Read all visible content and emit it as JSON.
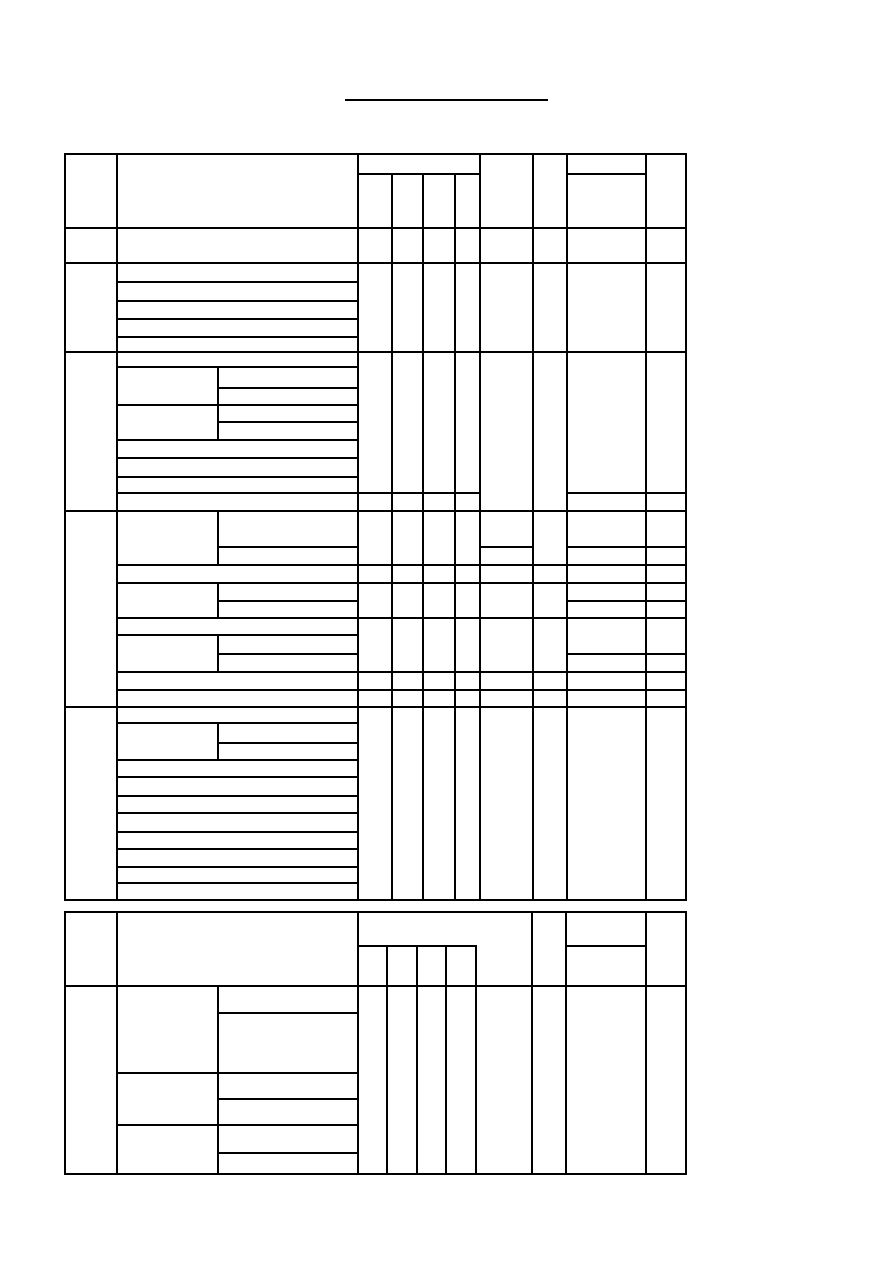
{
  "page": {
    "width": 893,
    "height": 1262,
    "background_color": "#ffffff",
    "line_color": "#000000",
    "line_thickness": 1.5
  },
  "title": {
    "text": "",
    "underline": {
      "x": 345,
      "y": 99,
      "width": 203,
      "thickness": 2
    }
  },
  "tables": [
    {
      "name": "upper-table",
      "vertical_lines": [
        [
          65,
          154,
          900
        ],
        [
          117,
          154,
          900
        ],
        [
          358,
          154,
          900
        ],
        [
          392,
          174,
          900
        ],
        [
          423,
          174,
          900
        ],
        [
          455,
          174,
          900
        ],
        [
          480,
          154,
          900
        ],
        [
          533,
          154,
          900
        ],
        [
          567,
          154,
          900
        ],
        [
          646,
          154,
          900
        ],
        [
          686,
          154,
          900
        ],
        [
          218,
          367,
          440
        ],
        [
          218,
          511,
          565
        ],
        [
          218,
          583,
          618
        ],
        [
          218,
          635,
          670
        ],
        [
          218,
          723,
          760
        ]
      ],
      "horizontal_lines": [
        [
          154,
          65,
          686
        ],
        [
          174,
          358,
          480
        ],
        [
          174,
          567,
          646
        ],
        [
          228,
          65,
          686
        ],
        [
          263,
          65,
          686
        ],
        [
          282,
          117,
          358
        ],
        [
          301,
          117,
          358
        ],
        [
          319,
          117,
          358
        ],
        [
          337,
          117,
          358
        ],
        [
          352,
          65,
          686
        ],
        [
          367,
          117,
          358
        ],
        [
          388,
          218,
          358
        ],
        [
          405,
          117,
          358
        ],
        [
          422,
          218,
          358
        ],
        [
          440,
          117,
          358
        ],
        [
          458,
          117,
          358
        ],
        [
          477,
          117,
          358
        ],
        [
          493,
          117,
          480
        ],
        [
          493,
          567,
          686
        ],
        [
          511,
          65,
          686
        ],
        [
          547,
          218,
          358
        ],
        [
          547,
          480,
          533
        ],
        [
          547,
          567,
          686
        ],
        [
          565,
          117,
          686
        ],
        [
          583,
          117,
          686
        ],
        [
          601,
          218,
          358
        ],
        [
          601,
          567,
          686
        ],
        [
          618,
          117,
          686
        ],
        [
          635,
          117,
          358
        ],
        [
          654,
          218,
          358
        ],
        [
          654,
          567,
          686
        ],
        [
          672,
          117,
          686
        ],
        [
          690,
          117,
          686
        ],
        [
          707,
          65,
          686
        ],
        [
          723,
          117,
          358
        ],
        [
          743,
          218,
          358
        ],
        [
          760,
          117,
          358
        ],
        [
          777,
          117,
          358
        ],
        [
          796,
          117,
          358
        ],
        [
          813,
          117,
          358
        ],
        [
          832,
          117,
          358
        ],
        [
          849,
          117,
          358
        ],
        [
          867,
          117,
          358
        ],
        [
          883,
          117,
          358
        ],
        [
          900,
          65,
          686
        ]
      ]
    },
    {
      "name": "lower-table",
      "vertical_lines": [
        [
          65,
          912,
          1174
        ],
        [
          117,
          912,
          1174
        ],
        [
          218,
          986,
          1174
        ],
        [
          358,
          912,
          1174
        ],
        [
          387,
          946,
          1174
        ],
        [
          417,
          946,
          1174
        ],
        [
          446,
          946,
          1174
        ],
        [
          476,
          946,
          1174
        ],
        [
          532,
          912,
          1174
        ],
        [
          566,
          912,
          1174
        ],
        [
          646,
          912,
          1174
        ],
        [
          686,
          912,
          1174
        ]
      ],
      "horizontal_lines": [
        [
          912,
          65,
          686
        ],
        [
          946,
          358,
          476
        ],
        [
          946,
          566,
          646
        ],
        [
          986,
          65,
          686
        ],
        [
          1013,
          218,
          358
        ],
        [
          1073,
          117,
          358
        ],
        [
          1099,
          218,
          358
        ],
        [
          1125,
          117,
          358
        ],
        [
          1153,
          218,
          358
        ],
        [
          1174,
          65,
          686
        ]
      ]
    }
  ]
}
